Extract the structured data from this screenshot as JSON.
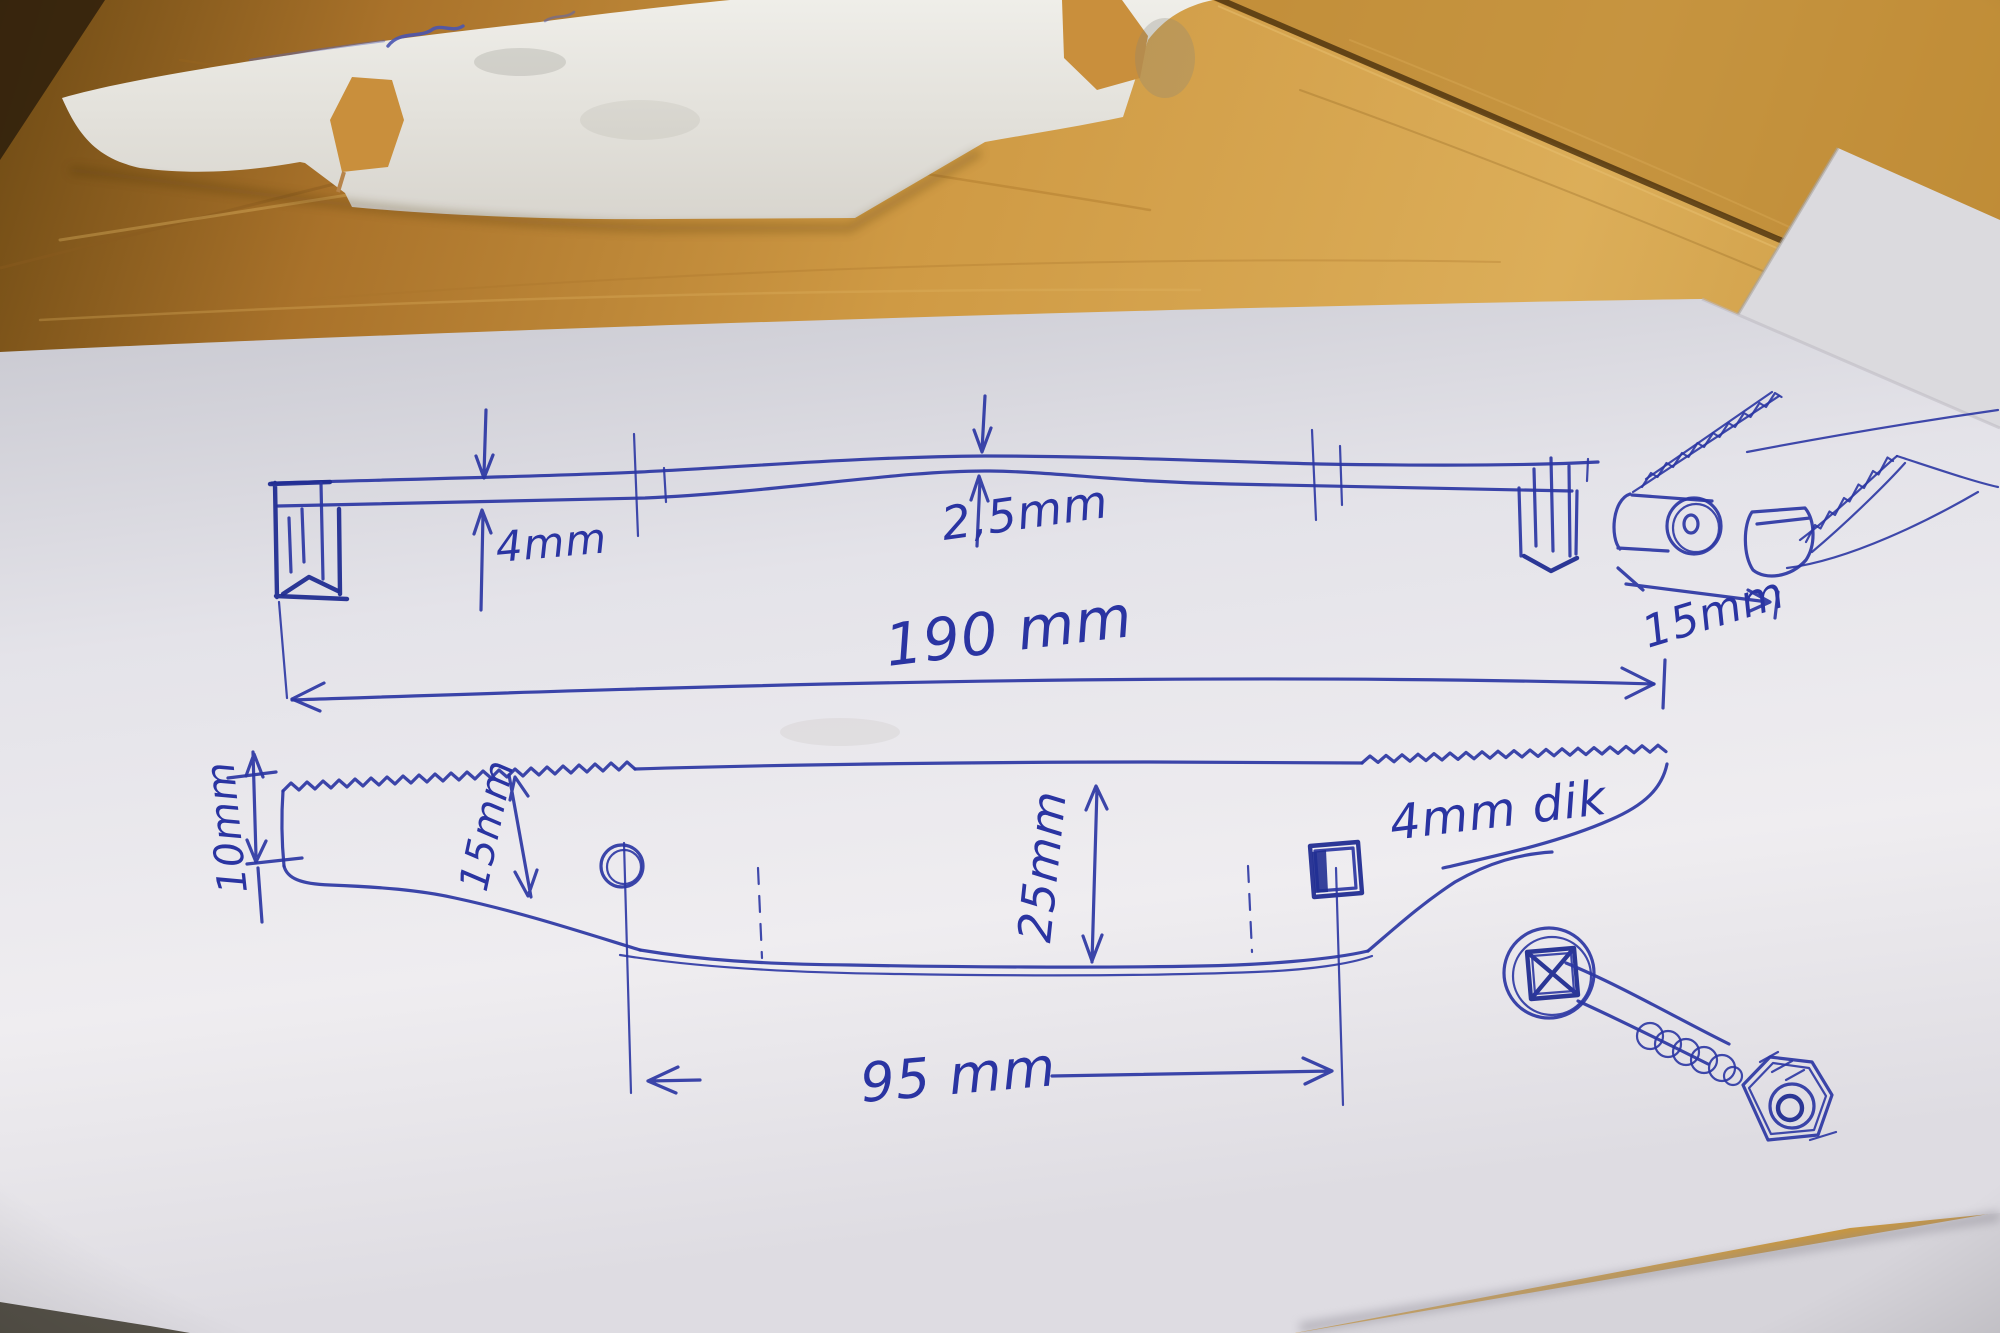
{
  "photo": {
    "scene": "Hand-drawn dimensioned sketch of a blade/scraper part in blue ballpoint pen on white paper, with a white cut-out paper template above, photographed on a wooden table",
    "pen_color": "#2b36a3",
    "wood_color": "#c8913d",
    "paper_color": "#e9e8ed"
  },
  "labels": {
    "side_thickness_left": "4mm",
    "side_thickness_middle": "2,5mm",
    "overall_length": "190 mm",
    "end_detail_width": "15mm",
    "left_end_height": "10mm",
    "blade_depth": "15mm",
    "body_height": "25mm",
    "material_thickness": "4mm dik",
    "hole_spacing": "95 mm"
  }
}
